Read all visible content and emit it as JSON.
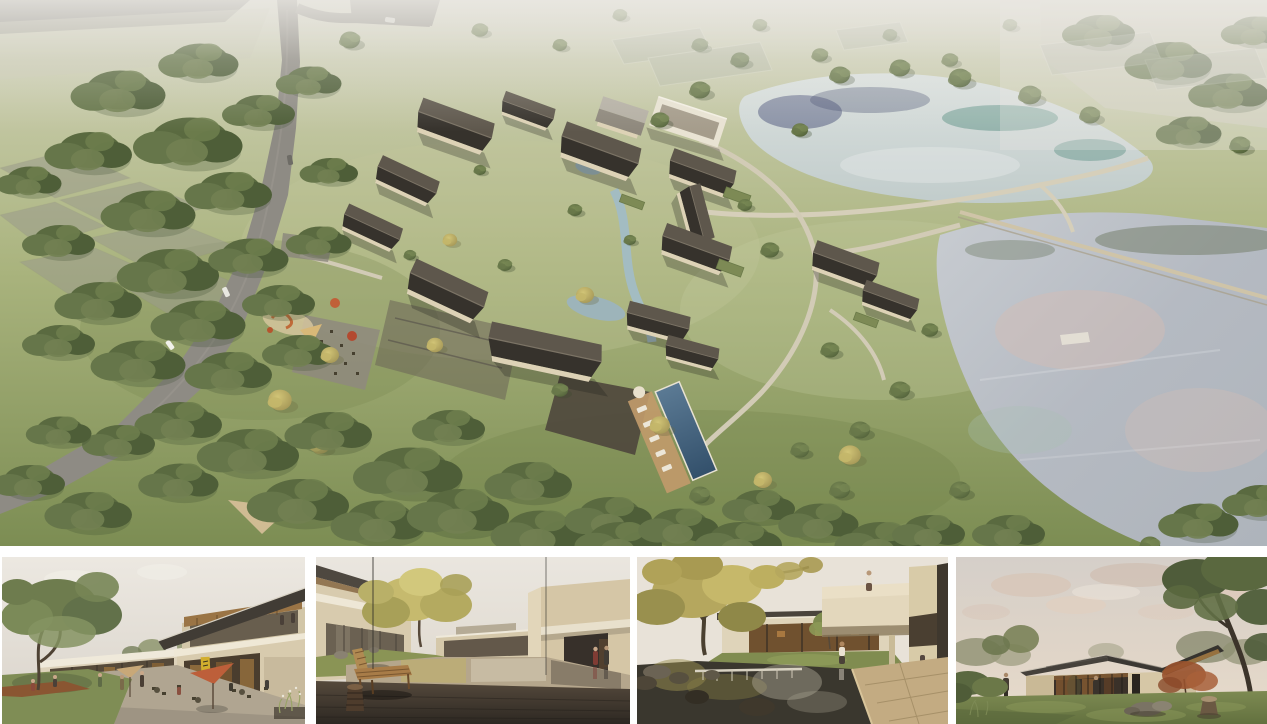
{
  "board": {
    "type": "architectural-rendering-presentation-board",
    "panel_count": 5,
    "title": "Courtyard village resort renderings",
    "panels": [
      {
        "id": "aerial",
        "label": "Aerial rendering of a courtyard village resort with dark gabled roofs beside two ponds, a country road winding through woodland on the left"
      },
      {
        "id": "street",
        "label": "Street-level view of a two-storey clubhouse with a tilted timber roof, shop fronts and outdoor cafe seating under an orange umbrella"
      },
      {
        "id": "reflecting-courtyard",
        "label": "Courtyard with a mirror-still reflecting pond, a wooden bench and carved log stool on a dark stone deck between beige villas"
      },
      {
        "id": "garden-courtyard",
        "label": "Garden courtyard with a cascading pond and weir, a large autumn tree and a cantilevered guest wing with a figure at the parapet"
      },
      {
        "id": "dusk-pavilion",
        "label": "Single-storey glass pavilion with a low dark roof on a lawn at dusk, framed by a large tree and a red maple"
      }
    ]
  },
  "palette": {
    "background": "#ffffff",
    "grass_light": "#c3c7a3",
    "grass_mid": "#a9b37d",
    "grass_dark": "#7c8d53",
    "forest_green": "#5a6a40",
    "autumn_yellow": "#c0b264",
    "road_grey": "#8e8b84",
    "field_grey": "#9b9b8c",
    "upper_pond": "#ccd5d3",
    "lower_pond": "#b8bdc4",
    "reflection_navy": "#475077",
    "reflection_teal": "#4f8a7c",
    "reflection_pink": "#d4bcb4",
    "roof_dark": "#38342e",
    "roof_light_slope": "#5e574c",
    "wall_cream": "#d8cbae",
    "timber": "#9a7445",
    "pool_blue": "#41607c",
    "accent_umbrella": "#bd5f3a",
    "accent_sign_yellow": "#d2ae2e",
    "corten": "#8a5632",
    "deck_dark": "#3a332c",
    "stone_tan": "#c3ab82",
    "dusk_cloud_pink": "#d8bfae",
    "haze_white": "#ebe9e4"
  }
}
